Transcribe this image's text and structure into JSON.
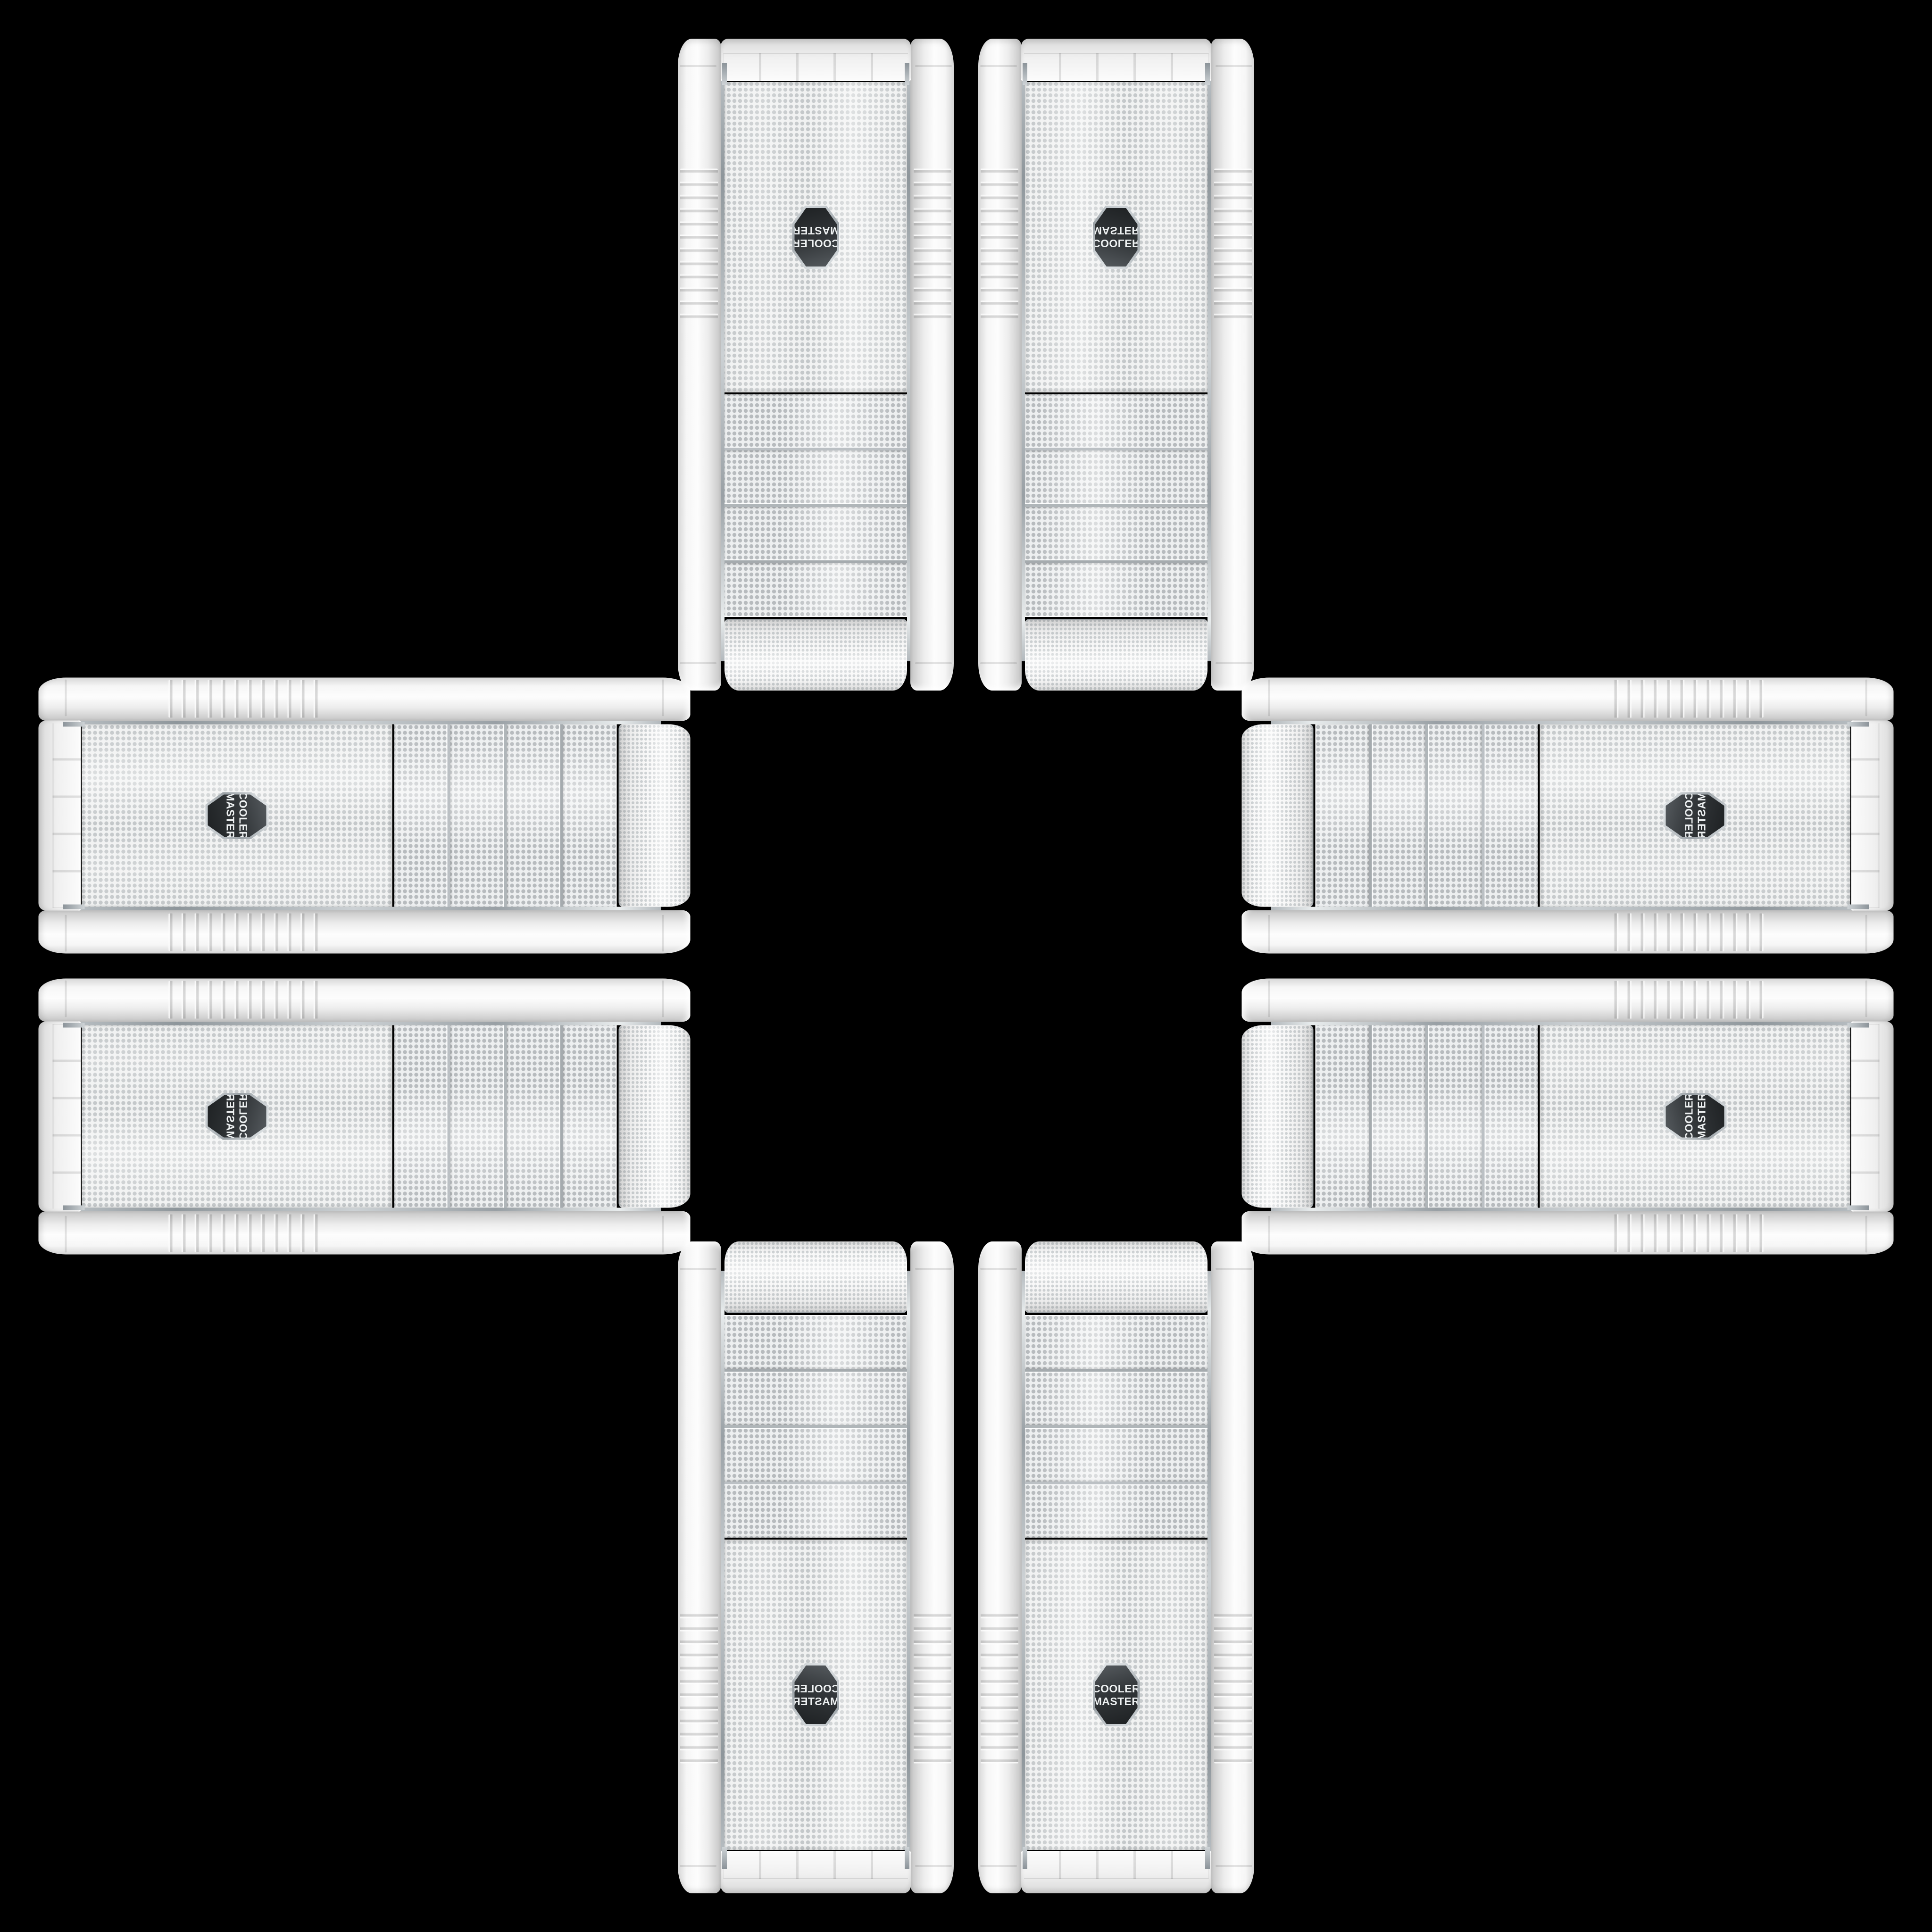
{
  "scene": {
    "type": "product-photo-collage",
    "background_color": "#000000",
    "product": "White Cooler Master PC tower case, front mesh view",
    "arrangement": "8 copies arranged in a plus/cross pattern around an empty black center",
    "case_body_color": "#f2f2f2",
    "mesh_dot_color": "#c3c7c9",
    "chrome_trim_color": "#9ea4a8",
    "badge_background_color": "#33373a",
    "badge_text_color": "#eef1f2"
  },
  "logo": {
    "line1": "COOLER",
    "line2": "MASTER"
  },
  "cases": [
    {
      "id": "top-left",
      "orientation": "rotated-180"
    },
    {
      "id": "top-right",
      "orientation": "flipped-vertical"
    },
    {
      "id": "left-top",
      "orientation": "rotated-90-cw"
    },
    {
      "id": "left-bottom",
      "orientation": "rotated-90-cw-flipped"
    },
    {
      "id": "right-top",
      "orientation": "rotated-90-ccw-flipped"
    },
    {
      "id": "right-bottom",
      "orientation": "rotated-90-ccw"
    },
    {
      "id": "bottom-left",
      "orientation": "mirrored-horizontal"
    },
    {
      "id": "bottom-right",
      "orientation": "upright"
    }
  ]
}
